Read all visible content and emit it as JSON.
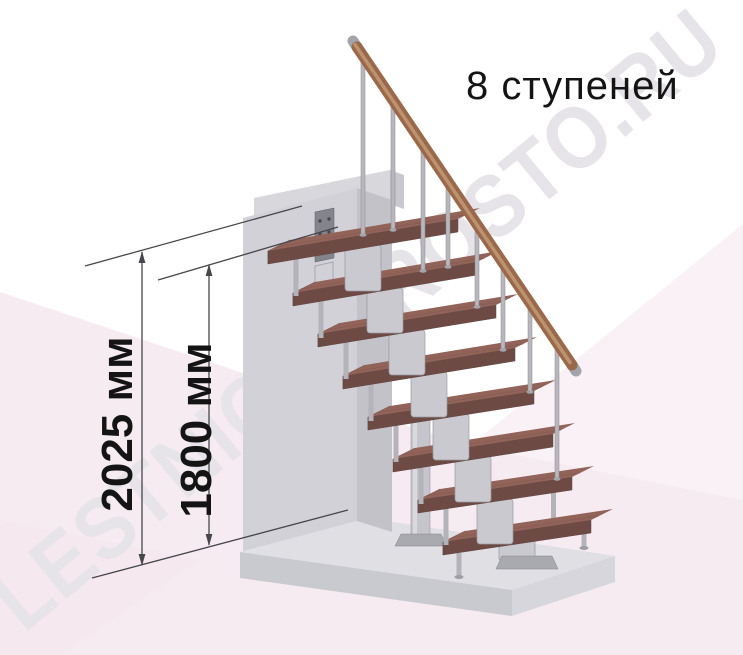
{
  "header": {
    "steps_label": "8 ступеней"
  },
  "dimensions": {
    "overall_height_label": "2025 мм",
    "flight_height_label": "1800 мм"
  },
  "watermark_text": "LESTNICA-PROSTO.RU",
  "staircase": {
    "steps_count": 8,
    "colors": {
      "tread_top": "#926359",
      "tread_front": "#6e4a45",
      "tread_end": "#7d544d",
      "handrail_wood": "#9a684a",
      "handrail_highlight": "#c49a76",
      "metal": "#c9c9cf",
      "baluster": "#b7b7bd",
      "wall": "#d1d1d7",
      "floor_slab": "#dfdfe4",
      "background_tint": "#f7ebf2",
      "dimension_line": "#46464b",
      "label_text": "#141414",
      "watermark": "#e7e4e9"
    }
  }
}
